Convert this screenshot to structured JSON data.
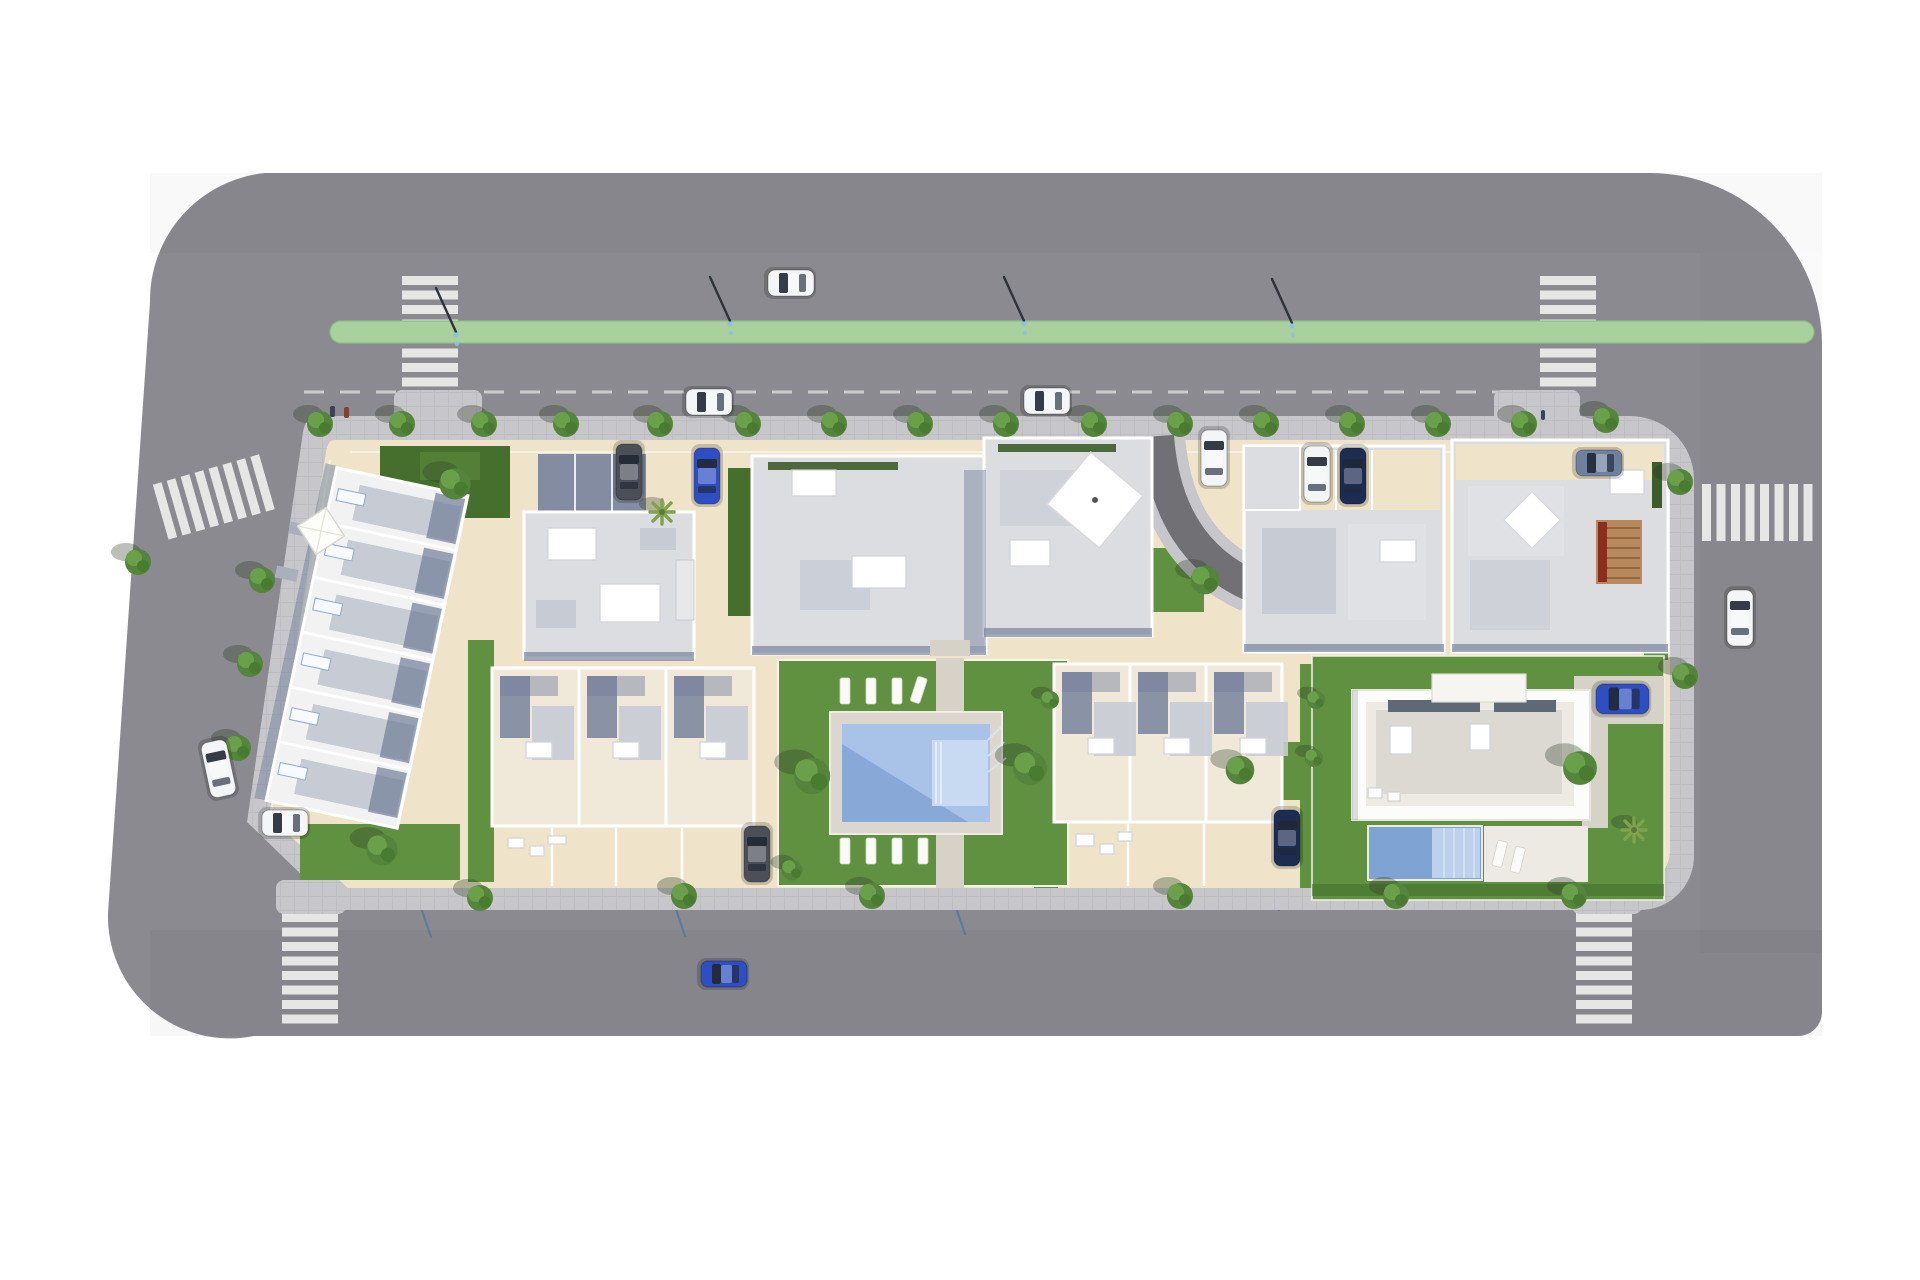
{
  "scene": {
    "type": "aerial top-down 3D architectural site-plan rendering",
    "subject": "residential development block (apartment buildings, townhouses, villa) surrounded by a perimeter road",
    "contains_text": false
  },
  "colors": {
    "bg": "#ffffff",
    "road": "#8a8a90",
    "sidewalk": "#c7c6ca",
    "paver_line": "#b3b2b8",
    "plot": "#efe4ca",
    "lane": "#a9d19e",
    "lane_edge": "#8cbf86",
    "stripe": "#e6e6e5",
    "dash": "#d2d2d4",
    "lawn": "#5f9140",
    "lawn_dark": "#466f2d",
    "hedge": "#3c5c2b",
    "path": "#d6d2c8",
    "roof_light": "#dcdde0",
    "roof_mid": "#c7ccd4",
    "roof_white": "#f2f2f3",
    "cream_roof": "#f0e9da",
    "wall_dark": "#707d99",
    "pool_deck": "#dcd7ce",
    "pool_water": "#a9c2e8",
    "pool_water_dark": "#7fa3d2",
    "pool_shelf": "#c8d9f2",
    "villa_white": "#fcfcfa",
    "villa_deck": "#eceae2",
    "villa_roof": "#dbd9d1",
    "villa_glass": "#5f6875",
    "pergola": "#b8895c",
    "pergola_red": "#8a2f1f",
    "car_white": "#f4f5f6",
    "car_blue": "#2e4fc4",
    "car_navy": "#1d2c52",
    "car_gray": "#4a4f58",
    "car_silver": "#6e82a0",
    "tree1": "#55853c",
    "tree2": "#6ba04b",
    "tree3": "#497c31",
    "palm": "#7fa24e",
    "shadow": "#2c3a26",
    "lounger": "#fafaf8",
    "lamp": "#2e333c",
    "lamp_blue": "#5a789e",
    "lamp_head": "#8fc0e8",
    "person1": "#3a4257",
    "person2": "#7a4436"
  },
  "inventory": {
    "roads": [
      "perimeter ring road around the block"
    ],
    "bike_lane": {
      "present": true,
      "color_name": "green",
      "position": "along top road"
    },
    "crosswalks": 6,
    "street_lamps": 10,
    "parking_dash_line": "top road parallel parking lane",
    "buildings": [
      {
        "id": "row-left",
        "kind": "diagonal row of 6 townhouses",
        "area": "west side"
      },
      {
        "id": "bldg-a",
        "kind": "apartment block with garage court",
        "area": "top middle-left"
      },
      {
        "id": "bldg-b",
        "kind": "large twin-wing apartment complex",
        "area": "top center"
      },
      {
        "id": "bldg-c",
        "kind": "apartment block with parking bays",
        "area": "top right"
      },
      {
        "id": "bldg-d",
        "kind": "apartment block with wooden pergola",
        "area": "top far right"
      },
      {
        "id": "row-bl",
        "kind": "row of 3 townhouses",
        "area": "bottom middle-left"
      },
      {
        "id": "row-br",
        "kind": "row of 3 townhouses",
        "area": "bottom middle-right"
      },
      {
        "id": "villa",
        "kind": "modern flat-roof villa with private pool",
        "area": "bottom right"
      }
    ],
    "amenities": [
      "communal swimming pool with sun deck",
      "8 communal sun loungers",
      "2 villa sun loungers",
      "lawned gardens",
      "curved private access street"
    ],
    "vehicles": [
      {
        "color": "white",
        "location": "top road, driving lane"
      },
      {
        "color": "white",
        "location": "top road, parking lane west"
      },
      {
        "color": "white",
        "location": "top road, parking lane east"
      },
      {
        "color": "white",
        "location": "right road"
      },
      {
        "color": "white",
        "location": "left road, angled"
      },
      {
        "color": "blue",
        "location": "bottom road"
      },
      {
        "color": "white",
        "location": "plot, bottom-left driveway"
      },
      {
        "color": "dark-gray",
        "location": "bldg-a garage court"
      },
      {
        "color": "blue",
        "location": "bldg-a driveway"
      },
      {
        "color": "white",
        "location": "curved street"
      },
      {
        "color": "white",
        "location": "bldg-c parking bay"
      },
      {
        "color": "navy",
        "location": "bldg-c parking bay"
      },
      {
        "color": "silver-blue",
        "location": "bldg-d driveway"
      },
      {
        "color": "blue",
        "location": "villa driveway"
      },
      {
        "color": "navy",
        "location": "row-br driveway"
      },
      {
        "color": "dark-gray",
        "location": "row-bl driveway"
      }
    ],
    "trees": 38,
    "palms": 2,
    "people": 3
  }
}
